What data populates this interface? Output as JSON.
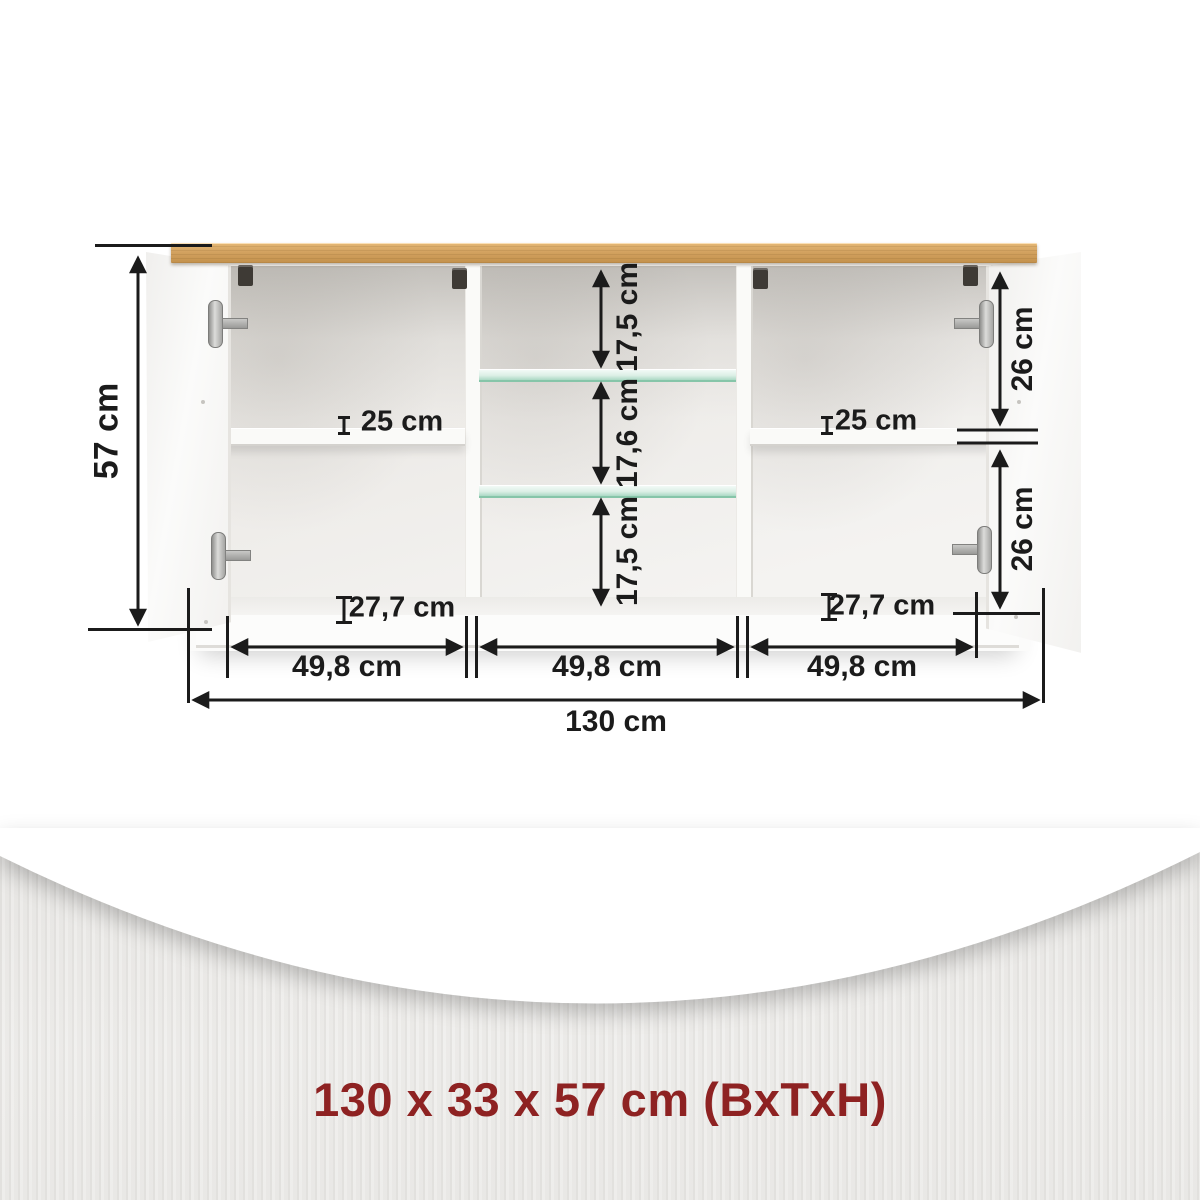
{
  "diagram": {
    "type": "furniture-dimension-diagram",
    "product": "sideboard-with-open-doors",
    "labels": {
      "height_total": "57 cm",
      "width_total": "130 cm",
      "width_section_left": "49,8 cm",
      "width_section_middle": "49,8 cm",
      "width_section_right": "49,8 cm",
      "middle_compartment_top": "17,5 cm",
      "middle_compartment_center": "17,6 cm",
      "middle_compartment_bottom": "17,5 cm",
      "right_compartment_top": "26 cm",
      "right_compartment_bottom": "26 cm",
      "shelf_depth_left": "25 cm",
      "shelf_depth_right": "25 cm",
      "base_depth_left": "27,7 cm",
      "base_depth_right": "27,7 cm"
    },
    "footer": {
      "dimensions_text": "130 x 33 x 57 cm (BxTxH)"
    },
    "colors": {
      "dimension_ink": "#1B1B1B",
      "accent_red": "#8E2222",
      "wood_top": "#D3A260",
      "band_gray": "#EBEAE8"
    }
  }
}
